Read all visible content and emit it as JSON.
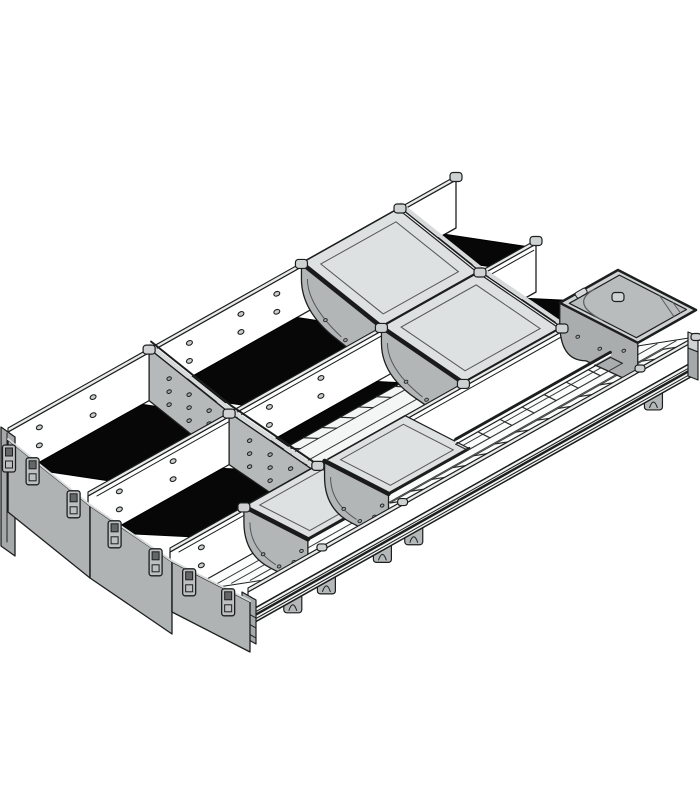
{
  "figure": {
    "alt": "Isometric technical line drawing of a drawer organizer cutlery insert with three side walls, cross dividers, hanging trays, a corner tray and a front rail"
  },
  "palette": {
    "background": "#ffffff",
    "outline": "#1d1f1f",
    "wall_face": "#ffffff",
    "wall_top": "#e9ebeb",
    "floor_black": "#070707",
    "floor_white": "#fbfcfc",
    "band_white": "#f4f6f6",
    "divider_face": "#b5b9b9",
    "divider_cap": "#d7dada",
    "back_panel_face": "#f3f5f5",
    "tray_face": "#b2b6b6",
    "tray_top": "#dde1e1",
    "tray_rim": "#1a1a1a",
    "box_rim": "#cfd3d3",
    "box_inner": "#b8bcbc",
    "box_body": "#a9adad",
    "front_panel": "#afb3b3",
    "front_post": "#a5a9a9",
    "clip_fill": "#bcc0c0",
    "clip_window": "#636767",
    "knob": "#ced2d2",
    "foot": "#b4b8b8",
    "hole_fill": "#c9cdcd",
    "dot_fill": "#9fa3a3"
  },
  "geometry": {
    "delta": [
      448,
      -252
    ],
    "wall_height": 52,
    "walls": [
      {
        "name": "wall-a",
        "front": [
          8,
          428
        ],
        "holes": [
          0.07,
          0.19,
          0.405,
          0.52,
          0.6
        ]
      },
      {
        "name": "wall-b",
        "front": [
          88,
          492
        ],
        "holes": [
          0.07,
          0.19,
          0.405,
          0.52
        ]
      },
      {
        "name": "wall-c",
        "front": [
          170,
          548
        ],
        "holes": [
          0.07,
          0.19
        ]
      }
    ],
    "front_rail_front": [
      248,
      588
    ],
    "hole_depths": [
      17,
      35
    ],
    "black_floors": [
      [
        0,
        0.045,
        0.3
      ],
      [
        0,
        0.345,
        0.645
      ],
      [
        0,
        0.895,
        0.975
      ],
      [
        1,
        0.045,
        0.3
      ],
      [
        1,
        0.33,
        0.645
      ],
      [
        1,
        0.895,
        0.975
      ]
    ],
    "row2_band": {
      "t1": 0.33,
      "t2": 0.645,
      "near": 0.3,
      "lines": [
        0.48,
        0.8
      ],
      "rungs": 8
    },
    "row3_floor": {
      "t1": 0.03,
      "t2": 0.995,
      "lines": [
        0.32,
        0.56,
        0.8
      ],
      "rung_k": 0.84,
      "rung_t1": 0.345,
      "rung_t2": 0.955,
      "rungs": 14
    },
    "dividers": [
      {
        "row": 0,
        "t": 0.315
      },
      {
        "row": 1,
        "t": 0.315
      }
    ],
    "back_panels": [
      {
        "row": 0,
        "t": 0.875
      },
      {
        "row": 1,
        "t": 0.875
      }
    ],
    "trays": [
      {
        "row": 0,
        "t": 0.655,
        "len": 0.215,
        "span": 1.0
      },
      {
        "row": 1,
        "t": 0.655,
        "len": 0.215,
        "span": 1.0
      },
      {
        "row": 2,
        "t": 0.165,
        "len": 0.18,
        "span": 0.82
      },
      {
        "row": 2,
        "t": 0.345,
        "len": 0.18,
        "span": 0.82
      }
    ],
    "mid_rail": {
      "t1": 0.53,
      "t2": 0.875,
      "k": 0.62,
      "rungs": 8
    },
    "corner_box": {
      "t1": 0.87,
      "t2": 1.0,
      "raise": 26
    },
    "feet": [
      0.1,
      0.175,
      0.3,
      0.37,
      0.905
    ],
    "front_panels": [
      {
        "top": [
          [
            8,
            440
          ],
          [
            90,
            506
          ]
        ],
        "h": 72,
        "clips": [
          0.3,
          0.8
        ]
      },
      {
        "top": [
          [
            90,
            506
          ],
          [
            172,
            562
          ]
        ],
        "h": 72,
        "clips": [
          0.3,
          0.8
        ]
      },
      {
        "top": [
          [
            172,
            562
          ],
          [
            250,
            602
          ]
        ],
        "h": 50,
        "clips": [
          0.22,
          0.72
        ]
      }
    ],
    "front_post": {
      "quad": [
        [
          1,
          427
        ],
        [
          15,
          437
        ],
        [
          15,
          556
        ],
        [
          1,
          546
        ]
      ],
      "clip": [
        9,
        456
      ]
    },
    "knobs": [
      [
        0,
        0.315
      ],
      [
        0,
        0.655
      ],
      [
        0,
        0.875
      ],
      [
        0,
        1.0
      ],
      [
        1,
        0.315
      ],
      [
        1,
        0.655
      ],
      [
        1,
        0.875
      ],
      [
        1,
        1.0
      ],
      [
        2,
        0.165
      ],
      [
        2,
        0.33
      ],
      [
        2,
        0.655
      ],
      [
        2,
        0.875
      ],
      [
        2,
        1.0
      ],
      [
        3,
        0.165
      ],
      [
        3,
        0.345
      ],
      [
        3,
        0.875
      ],
      [
        3,
        1.0
      ]
    ]
  }
}
